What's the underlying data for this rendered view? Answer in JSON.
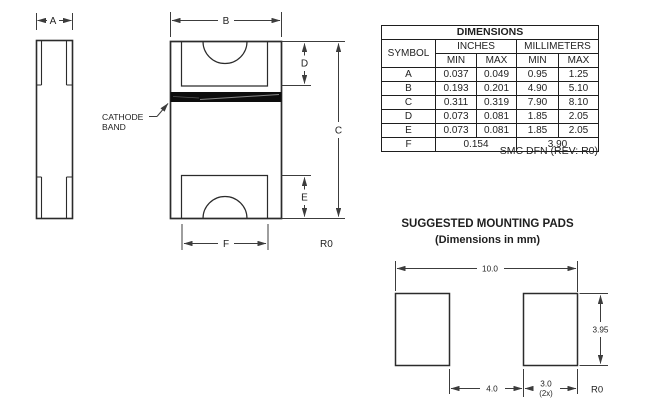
{
  "drawing": {
    "side_view": {
      "dim_a_label": "A"
    },
    "package_view": {
      "dim_b_label": "B",
      "dim_c_label": "C",
      "dim_d_label": "D",
      "dim_e_label": "E",
      "dim_f_label": "F",
      "cathode_line1": "CATHODE",
      "cathode_line2": "BAND",
      "rev_label": "R0"
    }
  },
  "dimensions_table": {
    "title": "DIMENSIONS",
    "col_symbol": "SYMBOL",
    "col_group_inches": "INCHES",
    "col_group_mm": "MILLIMETERS",
    "col_min": "MIN",
    "col_max": "MAX",
    "rows": [
      {
        "symbol": "A",
        "in_min": "0.037",
        "in_max": "0.049",
        "mm_min": "0.95",
        "mm_max": "1.25"
      },
      {
        "symbol": "B",
        "in_min": "0.193",
        "in_max": "0.201",
        "mm_min": "4.90",
        "mm_max": "5.10"
      },
      {
        "symbol": "C",
        "in_min": "0.311",
        "in_max": "0.319",
        "mm_min": "7.90",
        "mm_max": "8.10"
      },
      {
        "symbol": "D",
        "in_min": "0.073",
        "in_max": "0.081",
        "mm_min": "1.85",
        "mm_max": "2.05"
      },
      {
        "symbol": "E",
        "in_min": "0.073",
        "in_max": "0.081",
        "mm_min": "1.85",
        "mm_max": "2.05"
      }
    ],
    "row_f": {
      "symbol": "F",
      "inches": "0.154",
      "mm": "3.90"
    },
    "caption": "SMC DFN (REV: R0)"
  },
  "mounting_pads": {
    "title": "SUGGESTED MOUNTING PADS",
    "subtitle": "(Dimensions in mm)",
    "dim_total_width": "10.0",
    "dim_gap": "4.0",
    "dim_pad_width": "3.0",
    "dim_pad_width_qty": "(2x)",
    "dim_pad_height": "3.95",
    "rev_label": "R0"
  },
  "colors": {
    "background": "#ffffff",
    "object_line": "#2b2b2b",
    "dimension_line": "#3c3c3c",
    "text": "#1f1f1f",
    "cathode_band": "#0d0d0d"
  }
}
